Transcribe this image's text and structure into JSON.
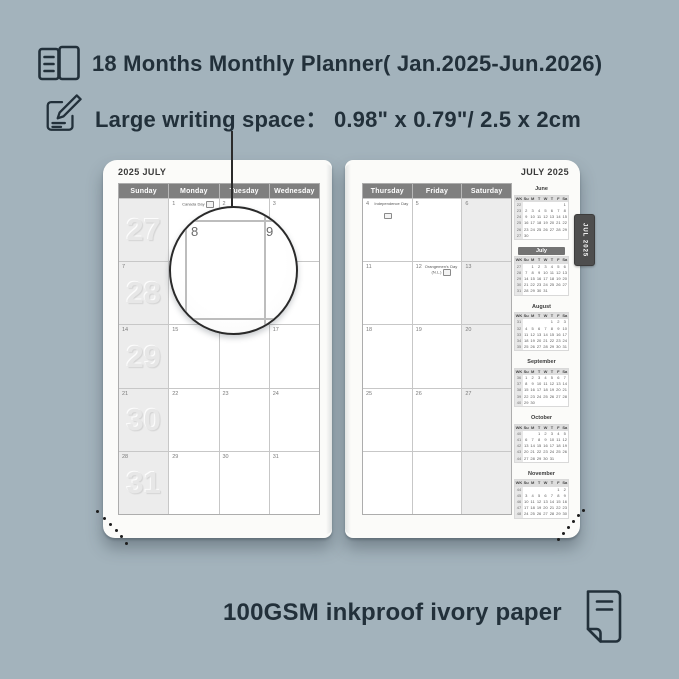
{
  "header": {
    "feature1": "18 Months Monthly Planner( Jan.2025-Jun.2026)",
    "feature2_label": "Large writing space：",
    "feature2_value": "0.98\" x 0.79\"/ 2.5 x 2cm"
  },
  "footer": {
    "text": "100GSM inkproof ivory paper"
  },
  "tab": {
    "label": "JUL 2025"
  },
  "magnifier": {
    "left_date": "8",
    "right_date": "9"
  },
  "left_page": {
    "title": "2025 JULY",
    "day_headers": [
      "Sunday",
      "Monday",
      "Tuesday",
      "Wednesday"
    ],
    "rows": [
      {
        "week_number": "27",
        "cells": [
          {
            "date": ""
          },
          {
            "date": "1",
            "note": "Canada Day",
            "flag": "inline"
          },
          {
            "date": "2"
          },
          {
            "date": "3"
          }
        ]
      },
      {
        "week_number": "28",
        "cells": [
          {
            "date": "7"
          },
          {
            "date": "8"
          },
          {
            "date": "9"
          },
          {
            "date": "10"
          }
        ]
      },
      {
        "week_number": "29",
        "cells": [
          {
            "date": "14"
          },
          {
            "date": "15"
          },
          {
            "date": "16"
          },
          {
            "date": "17"
          }
        ]
      },
      {
        "week_number": "30",
        "cells": [
          {
            "date": "21"
          },
          {
            "date": "22"
          },
          {
            "date": "23"
          },
          {
            "date": "24"
          }
        ]
      },
      {
        "week_number": "31",
        "cells": [
          {
            "date": "28"
          },
          {
            "date": "29"
          },
          {
            "date": "30"
          },
          {
            "date": "31"
          }
        ]
      }
    ]
  },
  "right_page": {
    "title": "JULY 2025",
    "day_headers": [
      "Thursday",
      "Friday",
      "Saturday"
    ],
    "rows": [
      {
        "cells": [
          {
            "date": "4",
            "note": "Independence Day",
            "flag": "below"
          },
          {
            "date": "5"
          },
          {
            "date": "6"
          }
        ]
      },
      {
        "cells": [
          {
            "date": "11"
          },
          {
            "date": "12",
            "note": "Orangemen's Day (N.L.)",
            "flag": "inline"
          },
          {
            "date": "13"
          }
        ]
      },
      {
        "cells": [
          {
            "date": "18"
          },
          {
            "date": "19"
          },
          {
            "date": "20"
          }
        ]
      },
      {
        "cells": [
          {
            "date": "25"
          },
          {
            "date": "26"
          },
          {
            "date": "27"
          }
        ]
      },
      {
        "cells": [
          {
            "date": ""
          },
          {
            "date": ""
          },
          {
            "date": ""
          }
        ]
      }
    ]
  },
  "sidebar": {
    "day_header": [
      "WK",
      "Su",
      "M",
      "T",
      "W",
      "T",
      "F",
      "Sa"
    ],
    "months": [
      {
        "name": "June",
        "highlight": false,
        "weeks": [
          [
            "22",
            "",
            "",
            "",
            "",
            "",
            "",
            "1"
          ],
          [
            "23",
            "2",
            "3",
            "4",
            "5",
            "6",
            "7",
            "8"
          ],
          [
            "24",
            "9",
            "10",
            "11",
            "12",
            "13",
            "14",
            "15"
          ],
          [
            "25",
            "16",
            "17",
            "18",
            "19",
            "20",
            "21",
            "22"
          ],
          [
            "26",
            "23",
            "24",
            "25",
            "26",
            "27",
            "28",
            "29"
          ],
          [
            "27",
            "30",
            "",
            "",
            "",
            "",
            "",
            ""
          ]
        ]
      },
      {
        "name": "July",
        "highlight": true,
        "weeks": [
          [
            "27",
            "",
            "1",
            "2",
            "3",
            "4",
            "5",
            "6"
          ],
          [
            "28",
            "7",
            "8",
            "9",
            "10",
            "11",
            "12",
            "13"
          ],
          [
            "29",
            "14",
            "15",
            "16",
            "17",
            "18",
            "19",
            "20"
          ],
          [
            "30",
            "21",
            "22",
            "23",
            "24",
            "25",
            "26",
            "27"
          ],
          [
            "31",
            "28",
            "29",
            "30",
            "31",
            "",
            "",
            ""
          ]
        ]
      },
      {
        "name": "August",
        "highlight": false,
        "weeks": [
          [
            "31",
            "",
            "",
            "",
            "",
            "1",
            "2",
            "3"
          ],
          [
            "32",
            "4",
            "5",
            "6",
            "7",
            "8",
            "9",
            "10"
          ],
          [
            "33",
            "11",
            "12",
            "13",
            "14",
            "15",
            "16",
            "17"
          ],
          [
            "34",
            "18",
            "19",
            "20",
            "21",
            "22",
            "23",
            "24"
          ],
          [
            "35",
            "25",
            "26",
            "27",
            "28",
            "29",
            "30",
            "31"
          ]
        ]
      },
      {
        "name": "September",
        "highlight": false,
        "weeks": [
          [
            "36",
            "1",
            "2",
            "3",
            "4",
            "5",
            "6",
            "7"
          ],
          [
            "37",
            "8",
            "9",
            "10",
            "11",
            "12",
            "13",
            "14"
          ],
          [
            "38",
            "15",
            "16",
            "17",
            "18",
            "19",
            "20",
            "21"
          ],
          [
            "39",
            "22",
            "23",
            "24",
            "25",
            "26",
            "27",
            "28"
          ],
          [
            "40",
            "29",
            "30",
            "",
            "",
            "",
            "",
            ""
          ]
        ]
      },
      {
        "name": "October",
        "highlight": false,
        "weeks": [
          [
            "40",
            "",
            "",
            "1",
            "2",
            "3",
            "4",
            "5"
          ],
          [
            "41",
            "6",
            "7",
            "8",
            "9",
            "10",
            "11",
            "12"
          ],
          [
            "42",
            "13",
            "14",
            "15",
            "16",
            "17",
            "18",
            "19"
          ],
          [
            "43",
            "20",
            "21",
            "22",
            "23",
            "24",
            "25",
            "26"
          ],
          [
            "44",
            "27",
            "28",
            "29",
            "30",
            "31",
            "",
            ""
          ]
        ]
      },
      {
        "name": "November",
        "highlight": false,
        "weeks": [
          [
            "44",
            "",
            "",
            "",
            "",
            "",
            "1",
            "2"
          ],
          [
            "45",
            "3",
            "4",
            "5",
            "6",
            "7",
            "8",
            "9"
          ],
          [
            "46",
            "10",
            "11",
            "12",
            "13",
            "14",
            "15",
            "16"
          ],
          [
            "47",
            "17",
            "18",
            "19",
            "20",
            "21",
            "22",
            "23"
          ],
          [
            "48",
            "24",
            "25",
            "26",
            "27",
            "28",
            "29",
            "30"
          ]
        ]
      }
    ]
  },
  "icons": {
    "feature1": "open-book-icon",
    "feature2": "writing-pencil-icon",
    "footer": "paper-sheet-icon",
    "holiday": "holiday-flag-icon"
  },
  "colors": {
    "background": "#a3b3bc",
    "ink": "#22303a",
    "page": "#fbfbf9",
    "header_bar": "#7f7f7f",
    "weekend_fill": "#ececec",
    "week_number": "#e7e7e7",
    "tab": "#4e4e4e",
    "mini_highlight": "#737373"
  }
}
